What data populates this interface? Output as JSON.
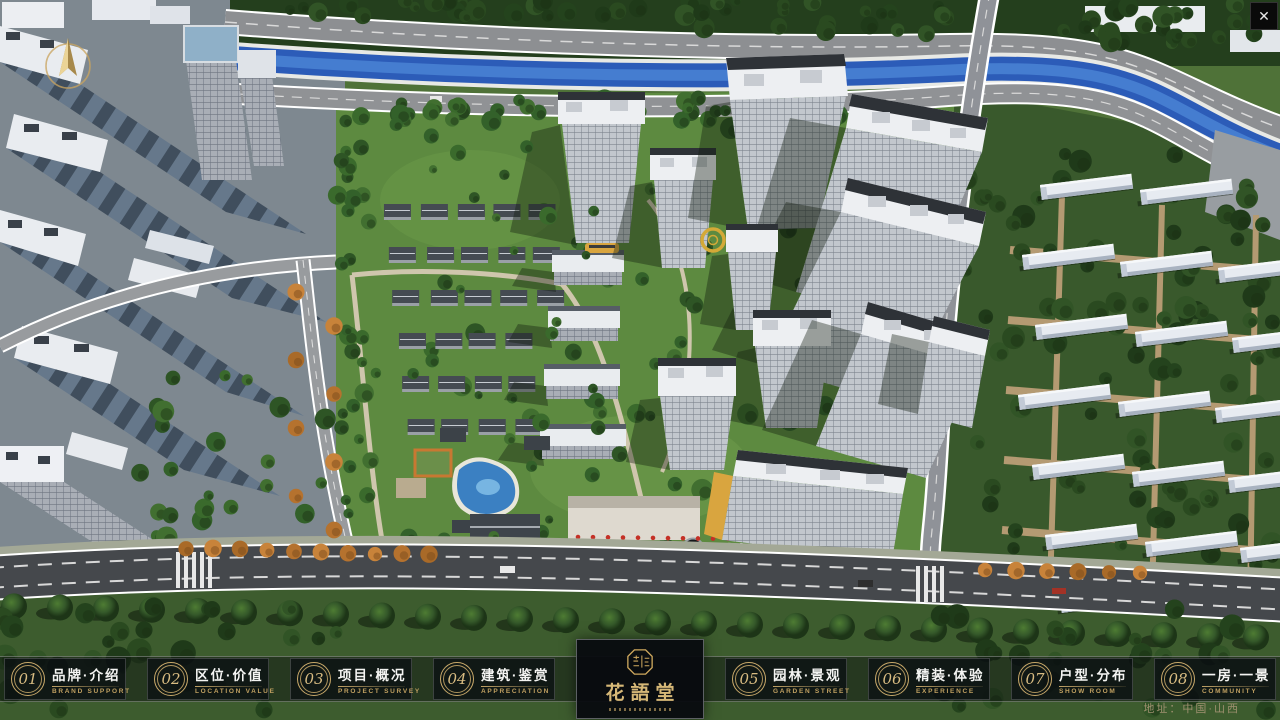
{
  "window": {
    "close_label": "✕"
  },
  "bottom_bar": {
    "items": [
      {
        "number": "01",
        "title": "品牌·介绍",
        "subtitle": "BRAND SUPPORT"
      },
      {
        "number": "02",
        "title": "区位·价值",
        "subtitle": "LOCATION VALUE"
      },
      {
        "number": "03",
        "title": "项目·概况",
        "subtitle": "PROJECT SURVEY"
      },
      {
        "number": "04",
        "title": "建筑·鉴赏",
        "subtitle": "APPRECIATION"
      },
      {
        "number": "05",
        "title": "园林·景观",
        "subtitle": "GARDEN STREET"
      },
      {
        "number": "06",
        "title": "精装·体验",
        "subtitle": "EXPERIENCE"
      },
      {
        "number": "07",
        "title": "户型·分布",
        "subtitle": "SHOW ROOM"
      },
      {
        "number": "08",
        "title": "一房·一景",
        "subtitle": "COMMUNITY"
      }
    ],
    "logo": {
      "name": "花語堂"
    },
    "address": "地址：中国·山西"
  },
  "colors": {
    "gold": "#c9a96a",
    "bar_bg": "rgba(10,13,16,0.45)",
    "river": "#2c5cb8"
  }
}
